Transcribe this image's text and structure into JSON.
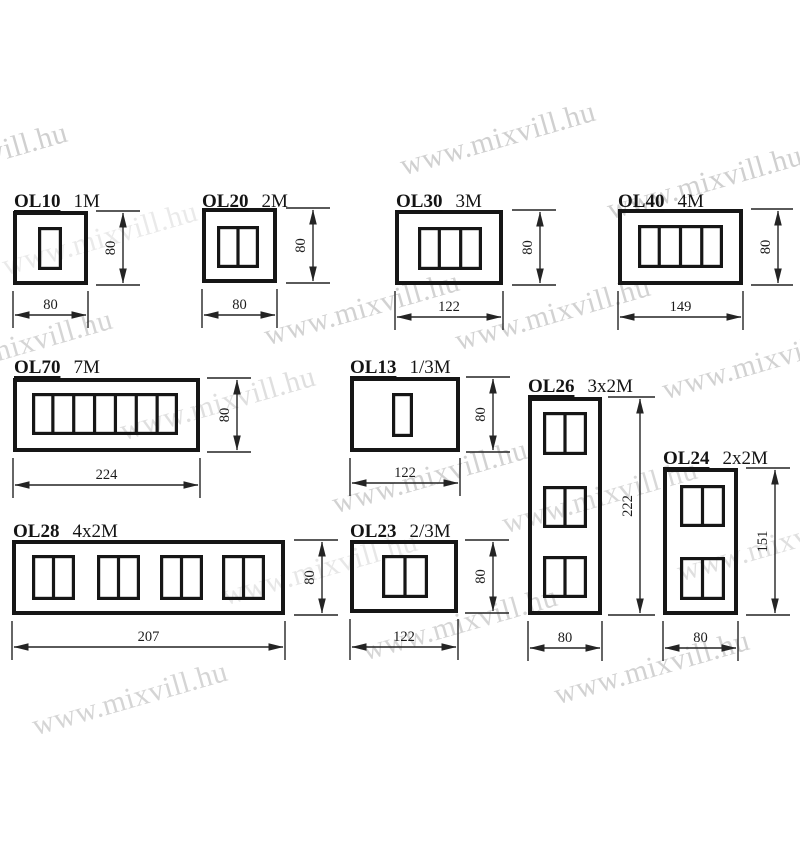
{
  "canvas": {
    "width": 800,
    "height": 850,
    "background": "#ffffff"
  },
  "watermark": {
    "text": "www.mixvill.hu",
    "color": "#cbcbcb",
    "font_size": 30,
    "rotation_deg": -16,
    "instances": [
      {
        "cx": -30,
        "cy": 163,
        "opacity": 0.9
      },
      {
        "cx": 498,
        "cy": 142,
        "opacity": 0.9
      },
      {
        "cx": 705,
        "cy": 186,
        "opacity": 0.9
      },
      {
        "cx": 100,
        "cy": 242,
        "opacity": 0.4
      },
      {
        "cx": 15,
        "cy": 350,
        "opacity": 0.8
      },
      {
        "cx": 362,
        "cy": 312,
        "opacity": 0.85
      },
      {
        "cx": 553,
        "cy": 317,
        "opacity": 0.85
      },
      {
        "cx": 760,
        "cy": 366,
        "opacity": 0.85
      },
      {
        "cx": 218,
        "cy": 407,
        "opacity": 0.6
      },
      {
        "cx": 430,
        "cy": 480,
        "opacity": 0.85
      },
      {
        "cx": 600,
        "cy": 500,
        "opacity": 0.75
      },
      {
        "cx": 775,
        "cy": 548,
        "opacity": 0.6
      },
      {
        "cx": 320,
        "cy": 572,
        "opacity": 0.45
      },
      {
        "cx": 460,
        "cy": 627,
        "opacity": 0.8
      },
      {
        "cx": 652,
        "cy": 671,
        "opacity": 0.85
      },
      {
        "cx": 130,
        "cy": 702,
        "opacity": 0.8
      }
    ]
  },
  "drawing": {
    "stroke_color": "#242424",
    "products": [
      {
        "name": "OL10",
        "modules": "1M",
        "label": {
          "x": 14,
          "y": 192
        },
        "box": {
          "x": 13,
          "y": 211,
          "w": 75,
          "h": 74
        },
        "module_groups": [
          {
            "x": 38,
            "y": 227,
            "w": 24,
            "h": 43,
            "cells": 1
          }
        ],
        "v_dim": {
          "value": "80",
          "line_x": 123,
          "ext_x1": 96,
          "ext_x2": 140
        },
        "h_dim": {
          "value": "80",
          "line_y": 315
        }
      },
      {
        "name": "OL20",
        "modules": "2M",
        "label": {
          "x": 202,
          "y": 192
        },
        "box": {
          "x": 202,
          "y": 208,
          "w": 75,
          "h": 75
        },
        "module_groups": [
          {
            "x": 217,
            "y": 226,
            "w": 42,
            "h": 42,
            "cells": 2
          }
        ],
        "v_dim": {
          "value": "80",
          "line_x": 313,
          "ext_x1": 286,
          "ext_x2": 330
        },
        "h_dim": {
          "value": "80",
          "line_y": 315
        }
      },
      {
        "name": "OL30",
        "modules": "3M",
        "label": {
          "x": 396,
          "y": 192
        },
        "box": {
          "x": 395,
          "y": 210,
          "w": 108,
          "h": 75
        },
        "module_groups": [
          {
            "x": 418,
            "y": 227,
            "w": 64,
            "h": 43,
            "cells": 3
          }
        ],
        "v_dim": {
          "value": "80",
          "line_x": 540,
          "ext_x1": 512,
          "ext_x2": 556
        },
        "h_dim": {
          "value": "122",
          "line_y": 317
        }
      },
      {
        "name": "OL40",
        "modules": "4M",
        "label": {
          "x": 618,
          "y": 192
        },
        "box": {
          "x": 618,
          "y": 209,
          "w": 125,
          "h": 76
        },
        "module_groups": [
          {
            "x": 638,
            "y": 225,
            "w": 85,
            "h": 43,
            "cells": 4
          }
        ],
        "v_dim": {
          "value": "80",
          "line_x": 778,
          "ext_x1": 751,
          "ext_x2": 793
        },
        "h_dim": {
          "value": "149",
          "line_y": 317
        }
      },
      {
        "name": "OL70",
        "modules": "7M",
        "label": {
          "x": 14,
          "y": 358
        },
        "box": {
          "x": 13,
          "y": 378,
          "w": 187,
          "h": 74
        },
        "module_groups": [
          {
            "x": 32,
            "y": 393,
            "w": 146,
            "h": 42,
            "cells": 7
          }
        ],
        "v_dim": {
          "value": "80",
          "line_x": 237,
          "ext_x1": 207,
          "ext_x2": 251
        },
        "h_dim": {
          "value": "224",
          "line_y": 485
        }
      },
      {
        "name": "OL13",
        "modules": "1/3M",
        "label": {
          "x": 350,
          "y": 358
        },
        "box": {
          "x": 350,
          "y": 377,
          "w": 110,
          "h": 75
        },
        "module_groups": [
          {
            "x": 392,
            "y": 393,
            "w": 21,
            "h": 44,
            "cells": 1
          }
        ],
        "v_dim": {
          "value": "80",
          "line_x": 493,
          "ext_x1": 466,
          "ext_x2": 510
        },
        "h_dim": {
          "value": "122",
          "line_y": 483
        }
      },
      {
        "name": "OL26",
        "modules": "3x2M",
        "label": {
          "x": 528,
          "y": 377
        },
        "box": {
          "x": 528,
          "y": 397,
          "w": 74,
          "h": 218
        },
        "module_groups": [
          {
            "x": 543,
            "y": 412,
            "w": 44,
            "h": 43,
            "cells": 2
          },
          {
            "x": 543,
            "y": 486,
            "w": 44,
            "h": 42,
            "cells": 2
          },
          {
            "x": 543,
            "y": 556,
            "w": 44,
            "h": 42,
            "cells": 2
          }
        ],
        "v_dim": {
          "value": "222",
          "line_x": 640,
          "ext_x1": 608,
          "ext_x2": 655
        },
        "h_dim": {
          "value": "80",
          "line_y": 648
        }
      },
      {
        "name": "OL24",
        "modules": "2x2M",
        "label": {
          "x": 663,
          "y": 449
        },
        "box": {
          "x": 663,
          "y": 468,
          "w": 75,
          "h": 147
        },
        "module_groups": [
          {
            "x": 680,
            "y": 485,
            "w": 45,
            "h": 42,
            "cells": 2
          },
          {
            "x": 680,
            "y": 557,
            "w": 45,
            "h": 43,
            "cells": 2
          }
        ],
        "v_dim": {
          "value": "151",
          "line_x": 775,
          "ext_x1": 746,
          "ext_x2": 790
        },
        "h_dim": {
          "value": "80",
          "line_y": 648
        }
      },
      {
        "name": "OL28",
        "modules": "4x2M",
        "label": {
          "x": 13,
          "y": 522
        },
        "box": {
          "x": 12,
          "y": 540,
          "w": 273,
          "h": 75
        },
        "module_groups": [
          {
            "x": 32,
            "y": 555,
            "w": 43,
            "h": 45,
            "cells": 2
          },
          {
            "x": 97,
            "y": 555,
            "w": 43,
            "h": 45,
            "cells": 2
          },
          {
            "x": 160,
            "y": 555,
            "w": 43,
            "h": 45,
            "cells": 2
          },
          {
            "x": 222,
            "y": 555,
            "w": 43,
            "h": 45,
            "cells": 2
          }
        ],
        "v_dim": {
          "value": "80",
          "line_x": 322,
          "ext_x1": 294,
          "ext_x2": 338
        },
        "h_dim": {
          "value": "207",
          "line_y": 647
        }
      },
      {
        "name": "OL23",
        "modules": "2/3M",
        "label": {
          "x": 350,
          "y": 522
        },
        "box": {
          "x": 350,
          "y": 540,
          "w": 108,
          "h": 73
        },
        "module_groups": [
          {
            "x": 382,
            "y": 555,
            "w": 46,
            "h": 43,
            "cells": 2
          }
        ],
        "v_dim": {
          "value": "80",
          "line_x": 493,
          "ext_x1": 465,
          "ext_x2": 509
        },
        "h_dim": {
          "value": "122",
          "line_y": 647
        }
      }
    ]
  }
}
